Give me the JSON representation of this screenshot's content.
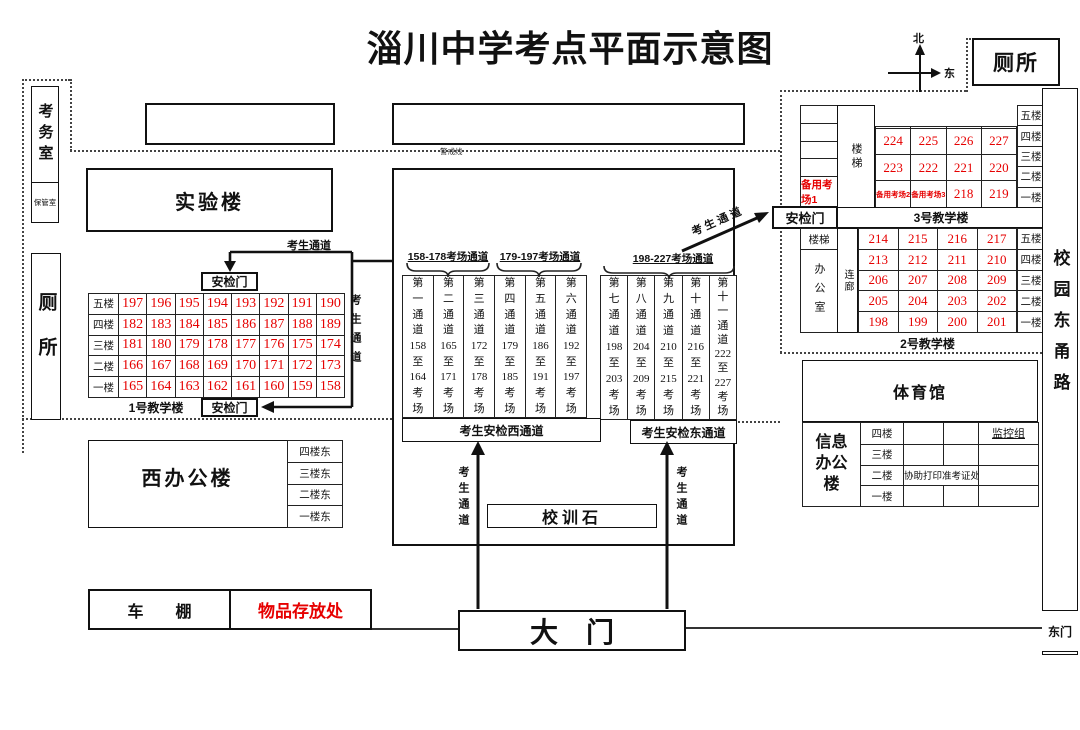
{
  "title": "淄川中学考点平面示意图",
  "compass": {
    "north": "北",
    "east": "东"
  },
  "cordon_label": "警戒线",
  "walkway_label": "考生通道",
  "exam_office": {
    "label": "考务室",
    "keep_room": "保管室"
  },
  "toilet_left": "厕所",
  "toilet_top": "厕所",
  "lab_building": "实验楼",
  "building1": {
    "name": "1号教学楼",
    "gate_top": "安检门",
    "gate_bottom": "安检门",
    "floors": [
      "五楼",
      "四楼",
      "三楼",
      "二楼",
      "一楼"
    ],
    "rooms": [
      [
        "197",
        "196",
        "195",
        "194",
        "193",
        "192",
        "191",
        "190"
      ],
      [
        "182",
        "183",
        "184",
        "185",
        "186",
        "187",
        "188",
        "189"
      ],
      [
        "181",
        "180",
        "179",
        "178",
        "177",
        "176",
        "175",
        "174"
      ],
      [
        "166",
        "167",
        "168",
        "169",
        "170",
        "171",
        "172",
        "173"
      ],
      [
        "165",
        "164",
        "163",
        "162",
        "161",
        "160",
        "159",
        "158"
      ]
    ]
  },
  "corridors": {
    "west_headers": [
      "158-178考场通道",
      "179-197考场通道"
    ],
    "east_header": "198-227考场通道",
    "west": [
      [
        "第",
        "一",
        "通",
        "道",
        "158",
        "至",
        "164",
        "考",
        "场"
      ],
      [
        "第",
        "二",
        "通",
        "道",
        "165",
        "至",
        "171",
        "考",
        "场"
      ],
      [
        "第",
        "三",
        "通",
        "道",
        "172",
        "至",
        "178",
        "考",
        "场"
      ],
      [
        "第",
        "四",
        "通",
        "道",
        "179",
        "至",
        "185",
        "考",
        "场"
      ],
      [
        "第",
        "五",
        "通",
        "道",
        "186",
        "至",
        "191",
        "考",
        "场"
      ],
      [
        "第",
        "六",
        "通",
        "道",
        "192",
        "至",
        "197",
        "考",
        "场"
      ]
    ],
    "east": [
      [
        "第",
        "七",
        "通",
        "道",
        "198",
        "至",
        "203",
        "考",
        "场"
      ],
      [
        "第",
        "八",
        "通",
        "道",
        "204",
        "至",
        "209",
        "考",
        "场"
      ],
      [
        "第",
        "九",
        "通",
        "道",
        "210",
        "至",
        "215",
        "考",
        "场"
      ],
      [
        "第",
        "十",
        "通",
        "道",
        "216",
        "至",
        "221",
        "考",
        "场"
      ],
      [
        "第",
        "十",
        "一",
        "通",
        "道",
        "222",
        "至",
        "227",
        "考",
        "场"
      ]
    ],
    "west_strip": "考生安检西通道",
    "east_strip": "考生安检东通道"
  },
  "motto_stone": "校训石",
  "main_gate": "大　门",
  "building3": {
    "name": "3号教学楼",
    "gate": "安检门",
    "stairs": "楼梯",
    "left_col": [
      "",
      "",
      "",
      "",
      "备用考场1"
    ],
    "floors": [
      "五楼",
      "四楼",
      "三楼",
      "二楼",
      "一楼"
    ],
    "grid": [
      [
        "",
        "",
        "",
        ""
      ],
      [
        "224",
        "225",
        "226",
        "227"
      ],
      [
        "223",
        "222",
        "221",
        "220"
      ],
      [
        "备用考场2",
        "备用考场3",
        "218",
        "219"
      ]
    ]
  },
  "building2": {
    "name": "2号教学楼",
    "stairs": "楼梯",
    "office": "办公室",
    "link": "连廊",
    "floors": [
      "五楼",
      "四楼",
      "三楼",
      "二楼",
      "一楼"
    ],
    "grid": [
      [
        "214",
        "215",
        "216",
        "217"
      ],
      [
        "213",
        "212",
        "211",
        "210"
      ],
      [
        "206",
        "207",
        "208",
        "209"
      ],
      [
        "205",
        "204",
        "203",
        "202"
      ],
      [
        "198",
        "199",
        "200",
        "201"
      ]
    ]
  },
  "gym": "体育馆",
  "info_building": {
    "name": "信息\n办公\n楼",
    "floors": [
      "四楼",
      "三楼",
      "二楼",
      "一楼"
    ],
    "monitor_label": "监控组",
    "print_label": "协助打印准考证处"
  },
  "west_office": {
    "name": "西办公楼",
    "floors": [
      "四楼东",
      "三楼东",
      "二楼东",
      "一楼东"
    ]
  },
  "bike_shed": "车　　棚",
  "storage": "物品存放处",
  "east_road": "校园东甬路",
  "east_gate": "东门",
  "colors": {
    "room_red": "#e60000",
    "line_black": "#111111"
  }
}
